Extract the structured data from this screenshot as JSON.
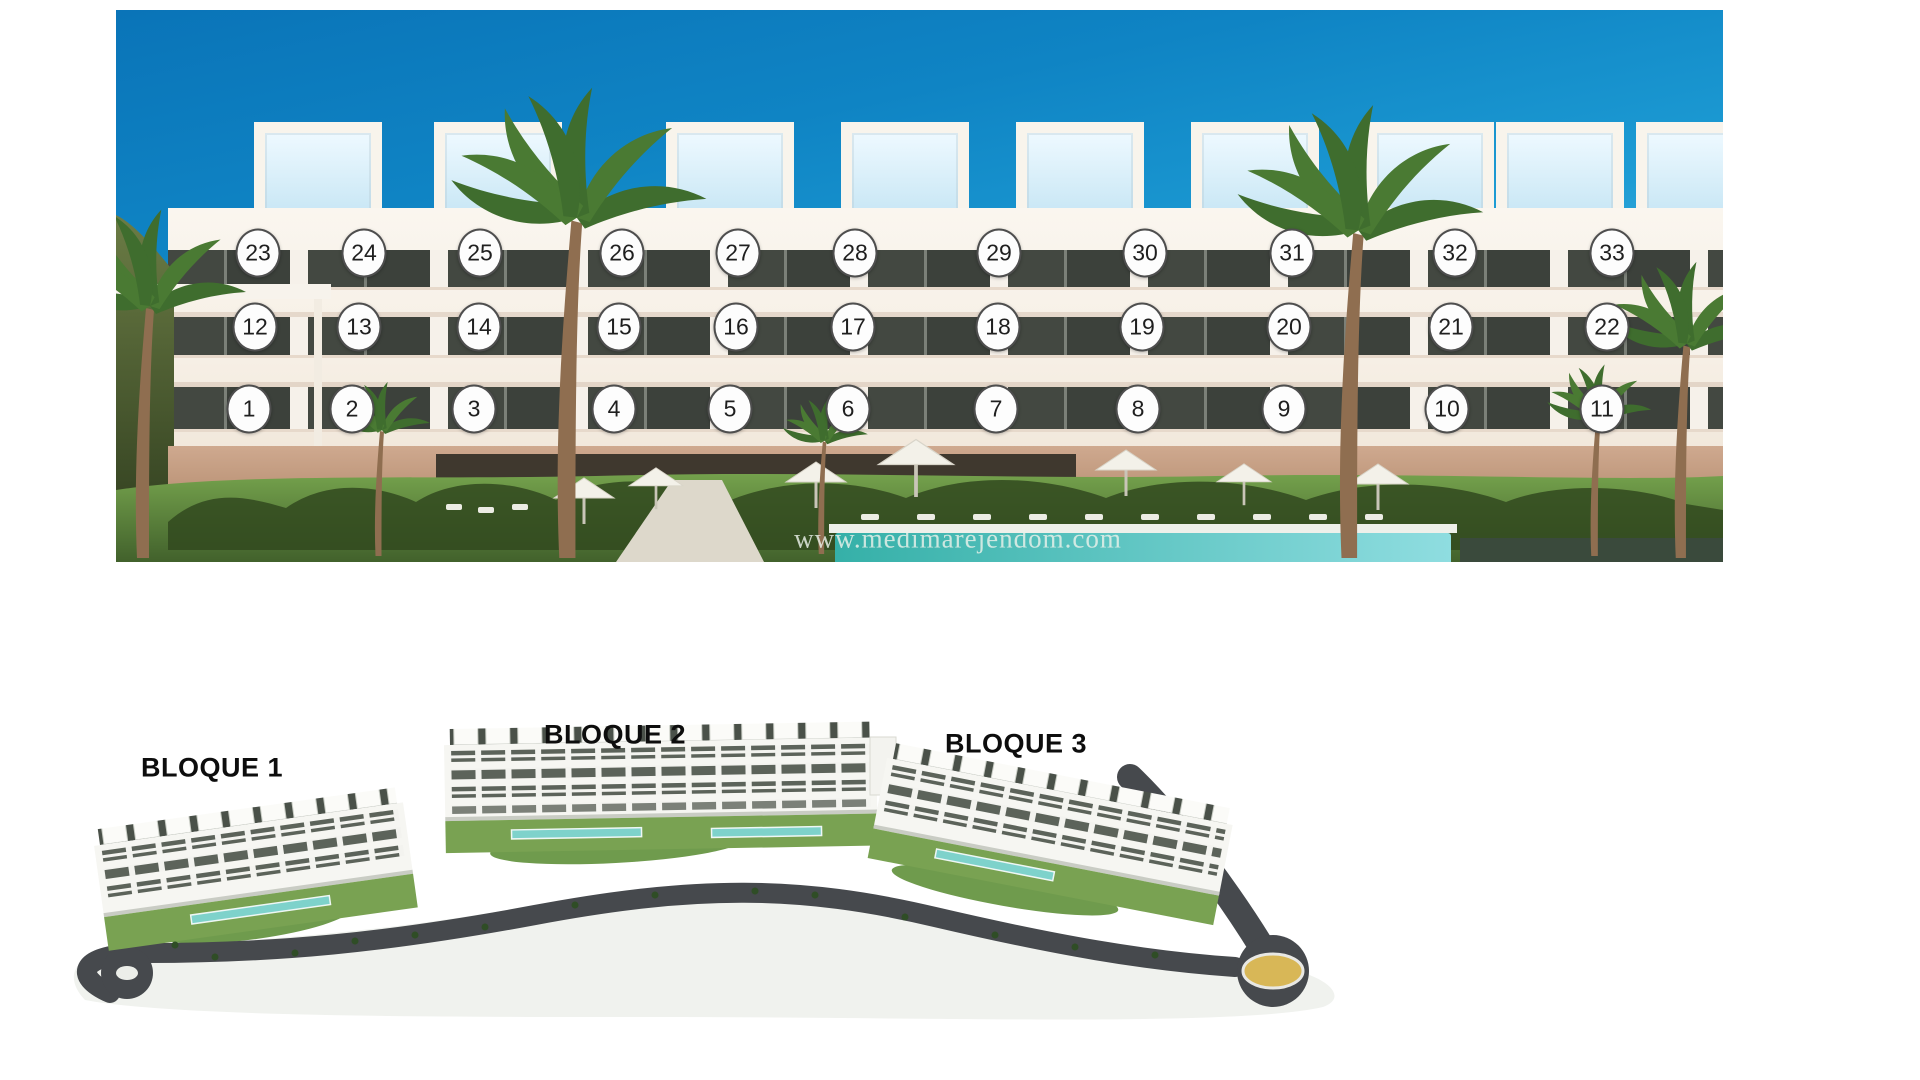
{
  "elevation": {
    "watermark": "www.medimarejendom.com",
    "floors": [
      {
        "name": "second-floor",
        "y": 253,
        "units": [
          {
            "n": "23",
            "x": 258
          },
          {
            "n": "24",
            "x": 364
          },
          {
            "n": "25",
            "x": 480
          },
          {
            "n": "26",
            "x": 622
          },
          {
            "n": "27",
            "x": 738
          },
          {
            "n": "28",
            "x": 855
          },
          {
            "n": "29",
            "x": 999
          },
          {
            "n": "30",
            "x": 1145
          },
          {
            "n": "31",
            "x": 1292
          },
          {
            "n": "32",
            "x": 1455
          },
          {
            "n": "33",
            "x": 1612
          }
        ]
      },
      {
        "name": "first-floor",
        "y": 327,
        "units": [
          {
            "n": "12",
            "x": 255
          },
          {
            "n": "13",
            "x": 359
          },
          {
            "n": "14",
            "x": 479
          },
          {
            "n": "15",
            "x": 619
          },
          {
            "n": "16",
            "x": 736
          },
          {
            "n": "17",
            "x": 853
          },
          {
            "n": "18",
            "x": 998
          },
          {
            "n": "19",
            "x": 1142
          },
          {
            "n": "20",
            "x": 1289
          },
          {
            "n": "21",
            "x": 1451
          },
          {
            "n": "22",
            "x": 1607
          }
        ]
      },
      {
        "name": "ground-floor",
        "y": 409,
        "units": [
          {
            "n": "1",
            "x": 249
          },
          {
            "n": "2",
            "x": 352
          },
          {
            "n": "3",
            "x": 474
          },
          {
            "n": "4",
            "x": 614
          },
          {
            "n": "5",
            "x": 730
          },
          {
            "n": "6",
            "x": 848
          },
          {
            "n": "7",
            "x": 996
          },
          {
            "n": "8",
            "x": 1138
          },
          {
            "n": "9",
            "x": 1284
          },
          {
            "n": "10",
            "x": 1447
          },
          {
            "n": "11",
            "x": 1602
          }
        ]
      }
    ]
  },
  "site_plan": {
    "labels": [
      {
        "text": "BLOQUE 1",
        "x": 212,
        "y": 768
      },
      {
        "text": "BLOQUE 2",
        "x": 615,
        "y": 735
      },
      {
        "text": "BLOQUE 3",
        "x": 1016,
        "y": 744
      }
    ]
  },
  "colors": {
    "sky_top": "#0a74b8",
    "sky_light": "#b9e2f1",
    "facade": "#f7f2ea",
    "window": "#434841",
    "stone": "#c7a189",
    "lawn": "#679544",
    "pool": "#54c3bd",
    "hedge": "#3a4a3c",
    "road": "#46494d",
    "roundabout_center": "#d8b757",
    "badge_bg": "#fdfdfd",
    "badge_border": "#4e4e4e",
    "badge_text": "#1f1f1f",
    "label_color": "#0d0d0d",
    "watermark_color": "rgba(236,242,234,0.82)"
  }
}
